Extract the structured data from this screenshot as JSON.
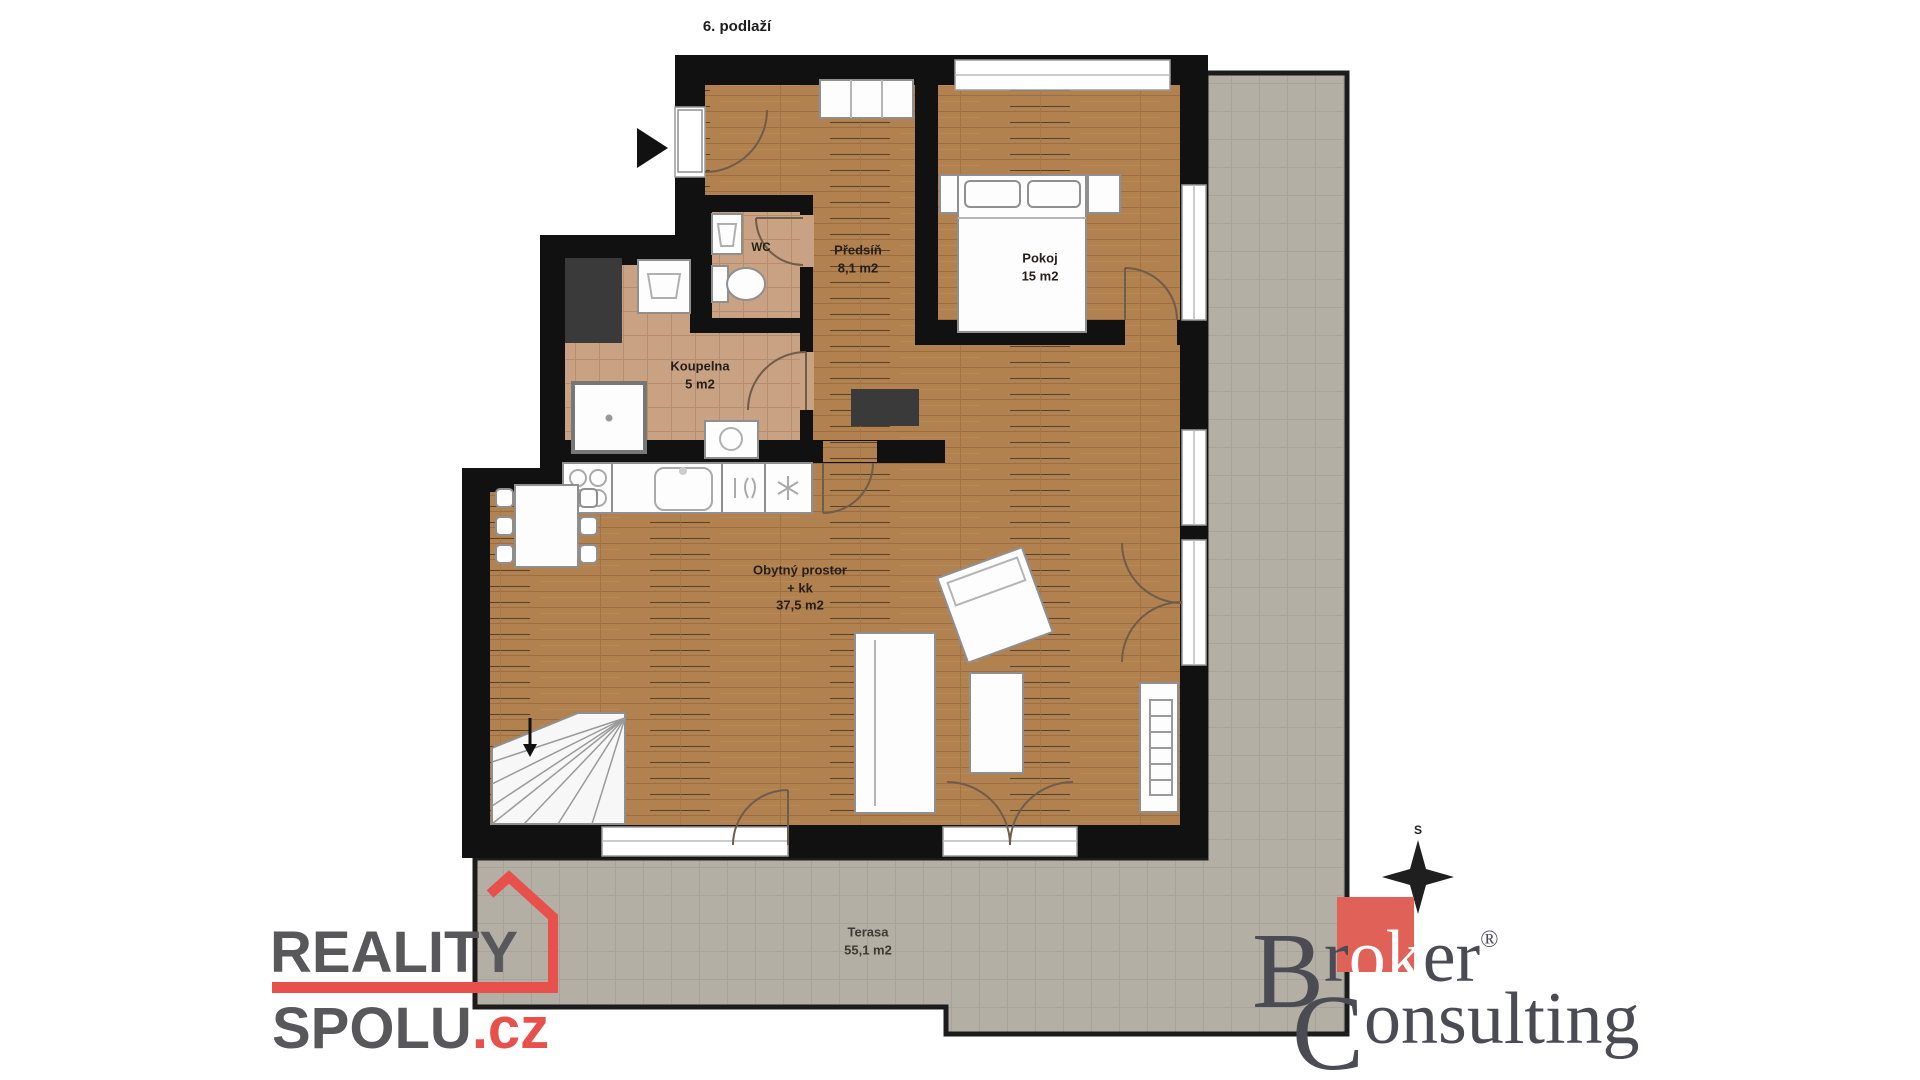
{
  "title": "6. podlaží",
  "labels": {
    "wc": {
      "name": "WC"
    },
    "predsin": {
      "name": "Předsíň",
      "area": "8,1 m2"
    },
    "pokoj": {
      "name": "Pokoj",
      "area": "15 m2"
    },
    "koupelna": {
      "name": "Koupelna",
      "area": "5 m2"
    },
    "obytny": {
      "name": "Obytný prostor",
      "sub": "+ kk",
      "area": "37,5 m2"
    },
    "terasa": {
      "name": "Terasa",
      "area": "55,1 m2"
    }
  },
  "compass": {
    "north_label": "S"
  },
  "logos": {
    "reality_spolu": {
      "line1": "REALITY",
      "line2": "SPOLU",
      "tld": ".cz",
      "accent_color": "#e8504b",
      "text_color": "#58585a"
    },
    "broker_consulting": {
      "word1_cap": "B",
      "word1_pre": "r",
      "word1_mid": "ok",
      "word1_post": "er",
      "registered": "®",
      "word2_cap": "C",
      "word2_rest": "onsulting",
      "square_color": "#e06158",
      "text_color": "#4b4b54"
    }
  },
  "colors": {
    "wall": "#111111",
    "wood_floor": "#b28150",
    "tile_floor": "#c9a183",
    "terrace": "#b3afa5",
    "shaft": "#3b3a3a",
    "furniture_stroke": "#8f8f8f"
  }
}
